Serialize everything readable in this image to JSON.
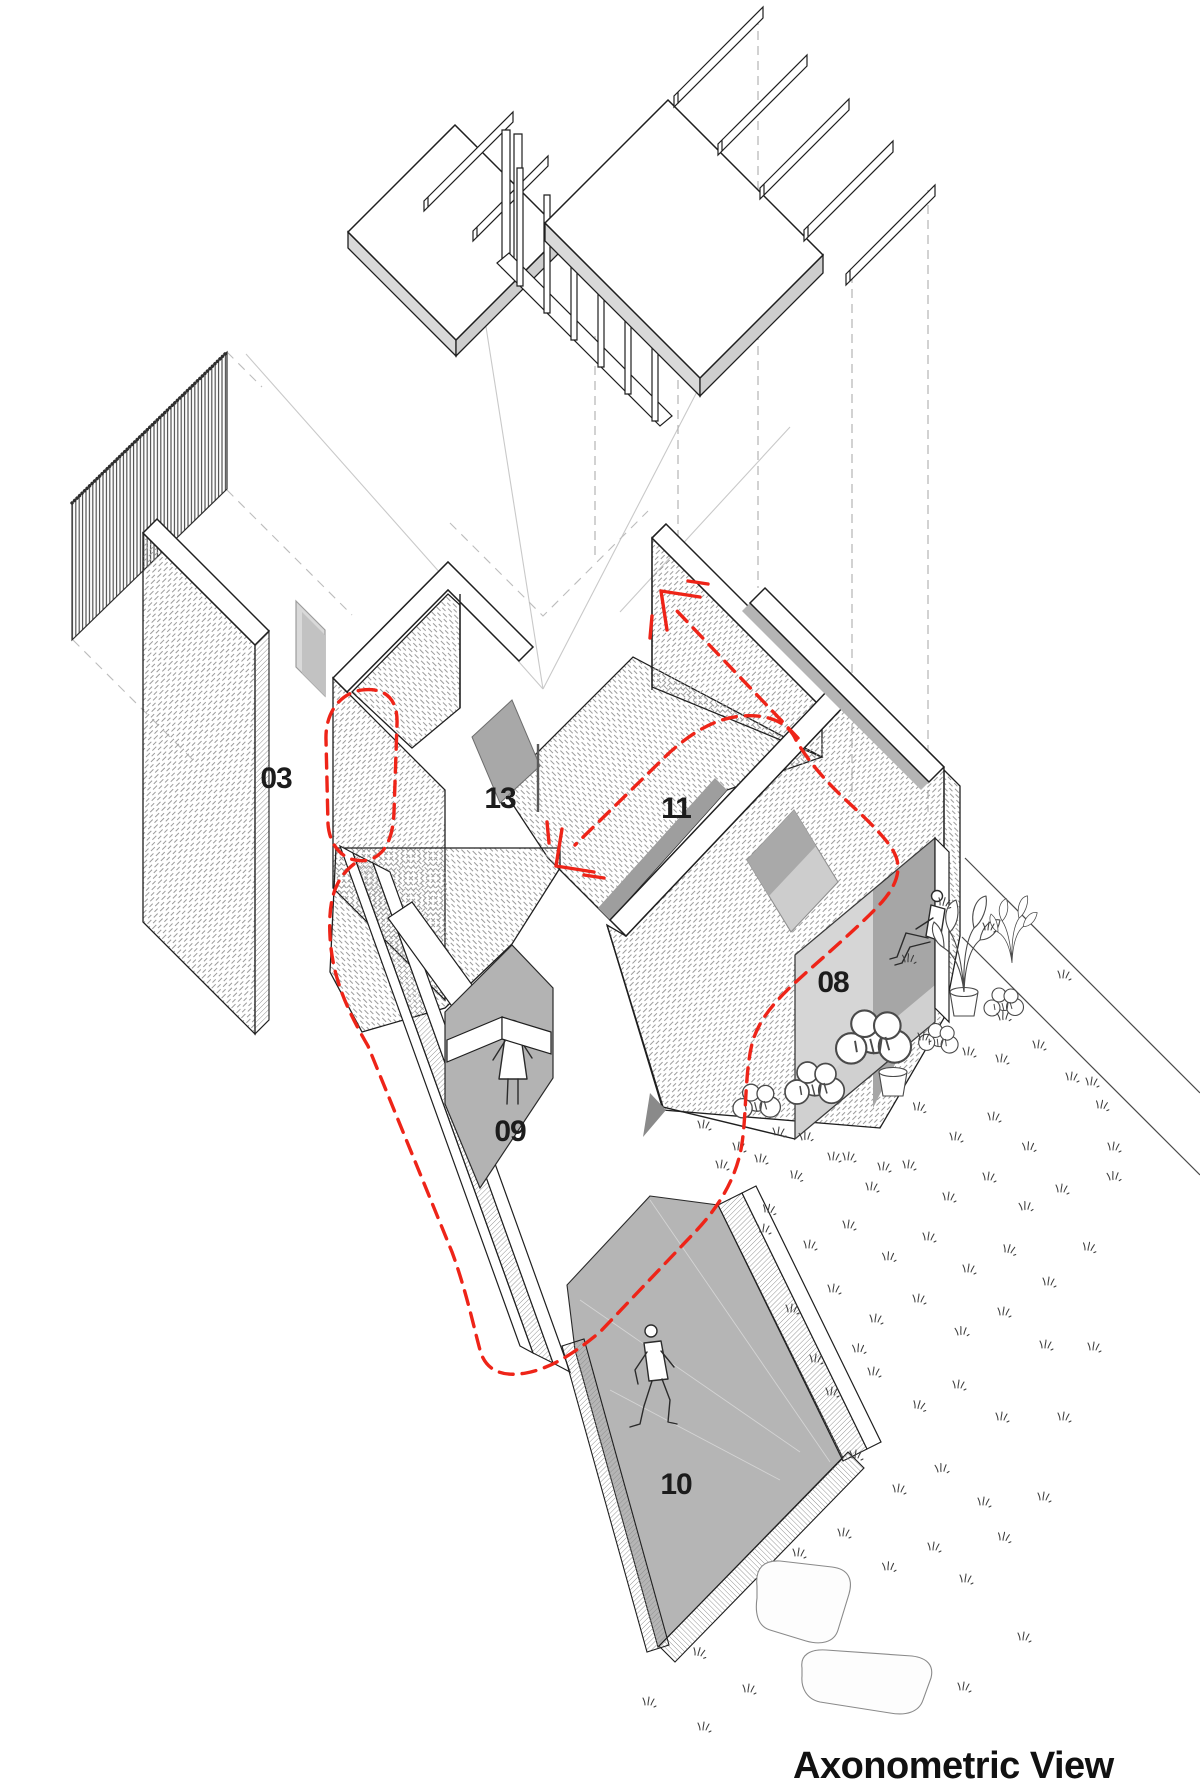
{
  "diagram": {
    "title": "Axonometric View",
    "space_labels": [
      {
        "id": "03"
      },
      {
        "id": "13"
      },
      {
        "id": "11"
      },
      {
        "id": "08"
      },
      {
        "id": "09"
      },
      {
        "id": "10"
      }
    ],
    "colors": {
      "circulation_red": "#ee2418",
      "label_ink": "#1c1c1c",
      "floor_gray": "#b5b5b5",
      "hatch_line": "#9b9b9b"
    }
  }
}
